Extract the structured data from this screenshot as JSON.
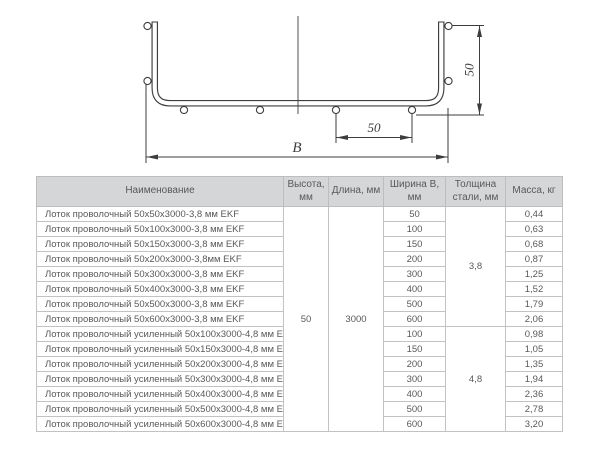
{
  "diagram": {
    "width_label": "B",
    "spacing_label": "50",
    "height_label": "50",
    "line_color": "#3d3d3d"
  },
  "table": {
    "headers": {
      "name": "Наименование",
      "height": "Высота, мм",
      "length": "Длина, мм",
      "width": "Ширина В, мм",
      "thickness": "Толщина стали, мм",
      "mass": "Масса, кг"
    },
    "height_mm": "50",
    "length_mm": "3000",
    "groups": [
      {
        "thickness_mm": "3,8",
        "rows": [
          {
            "name": "Лоток проволочный 50х50х3000-3,8 мм EKF",
            "width": "50",
            "mass": "0,44"
          },
          {
            "name": "Лоток проволочный 50х100х3000-3,8 мм EKF",
            "width": "100",
            "mass": "0,63"
          },
          {
            "name": "Лоток проволочный 50х150х3000-3,8 мм EKF",
            "width": "150",
            "mass": "0,68"
          },
          {
            "name": "Лоток проволочный 50х200х3000-3,8мм EKF",
            "width": "200",
            "mass": "0,87"
          },
          {
            "name": "Лоток проволочный 50х300х3000-3,8 мм EKF",
            "width": "300",
            "mass": "1,25"
          },
          {
            "name": "Лоток проволочный 50х400х3000-3,8 мм EKF",
            "width": "400",
            "mass": "1,52"
          },
          {
            "name": "Лоток проволочный 50х500х3000-3,8 мм EKF",
            "width": "500",
            "mass": "1,79"
          },
          {
            "name": "Лоток проволочный 50х600х3000-3,8 мм EKF",
            "width": "600",
            "mass": "2,06"
          }
        ]
      },
      {
        "thickness_mm": "4,8",
        "rows": [
          {
            "name": "Лоток проволочный усиленный 50х100х3000-4,8 мм EKF",
            "width": "100",
            "mass": "0,98"
          },
          {
            "name": "Лоток проволочный усиленный 50х150х3000-4,8 мм EKF",
            "width": "150",
            "mass": "1,05"
          },
          {
            "name": "Лоток проволочный усиленный 50х200х3000-4,8 мм EKF",
            "width": "200",
            "mass": "1,35"
          },
          {
            "name": "Лоток проволочный усиленный 50х300х3000-4,8 мм EKF",
            "width": "300",
            "mass": "1,94"
          },
          {
            "name": "Лоток проволочный усиленный 50х400х3000-4,8 мм EKF",
            "width": "400",
            "mass": "2,36"
          },
          {
            "name": "Лоток проволочный усиленный 50х500х3000-4,8 мм EKF",
            "width": "500",
            "mass": "2,78"
          },
          {
            "name": "Лоток проволочный усиленный 50х600х3000-4,8 мм EKF",
            "width": "600",
            "mass": "3,20"
          }
        ]
      }
    ]
  },
  "colors": {
    "header_bg": "#d5d6d8",
    "border": "#bdbdbd",
    "text": "#58595b",
    "drawing_line": "#3d3d3d"
  }
}
